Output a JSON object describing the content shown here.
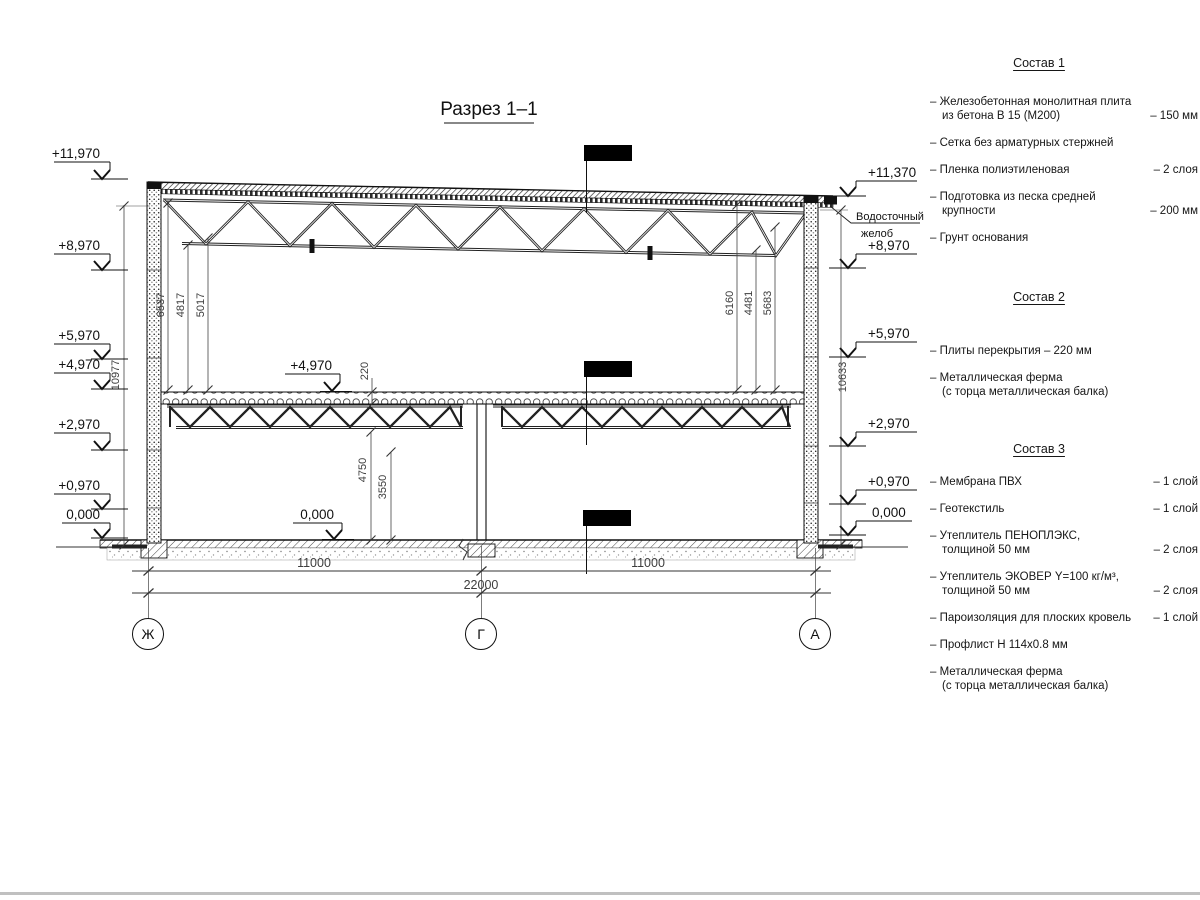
{
  "title": "Разрез 1–1",
  "drawing": {
    "elev_left": [
      "+11,970",
      "+8,970",
      "+5,970",
      "+4,970",
      "+2,970",
      "+0,970",
      "0,000"
    ],
    "elev_right": [
      "+11,370",
      "+8,970",
      "+5,970",
      "+2,970",
      "+0,970",
      "0,000"
    ],
    "elev_mid_floor": "+4,970",
    "elev_mid_zero": "0,000",
    "dim_left_total": "10977",
    "dim_right_total": "10633",
    "dim_left_inner": [
      "6537",
      "4817",
      "5017"
    ],
    "dim_right_inner": [
      "6160",
      "4481",
      "5683"
    ],
    "dim_slab": "220",
    "dim_v1": "4750",
    "dim_v2": "3550",
    "dim_span_left": "11000",
    "dim_span_right": "11000",
    "dim_total": "22000",
    "axes": [
      "Ж",
      "Г",
      "А"
    ],
    "gutter_label_1": "Водосточный",
    "gutter_label_2": "желоб"
  },
  "legend": {
    "sections": [
      {
        "title": "Состав 1",
        "items": [
          {
            "text": "– Железобетонная  монолитная плита\nиз бетона В 15 (М200)",
            "value": "–  150 мм"
          },
          {
            "text": "– Сетка без арматурных стержней",
            "value": ""
          },
          {
            "text": "– Пленка полиэтиленовая",
            "value": "–  2 слоя"
          },
          {
            "text": "– Подготовка из песка средней\nкрупности",
            "value": "–  200 мм"
          },
          {
            "text": "– Грунт основания",
            "value": ""
          }
        ]
      },
      {
        "title": "Состав 2",
        "items": [
          {
            "text": "– Плиты перекрытия – 220 мм",
            "value": ""
          },
          {
            "text": "– Металлическая ферма\n(с торца металлическая балка)",
            "value": ""
          }
        ]
      },
      {
        "title": "Состав 3",
        "items": [
          {
            "text": "– Мембрана ПВХ",
            "value": "– 1 слой"
          },
          {
            "text": "– Геотекстиль",
            "value": "– 1 слой"
          },
          {
            "text": "– Утеплитель ПЕНОПЛЭКС,\nтолщиной 50 мм",
            "value": "– 2 слоя"
          },
          {
            "text": "– Утеплитель ЭКОВЕР Y=100 кг/м³,\nтолщиной 50 мм",
            "value": "– 2 слоя"
          },
          {
            "text": "– Пароизоляция для плоских кровель",
            "value": "– 1 слой"
          },
          {
            "text": "– Профлист Н 114х0.8 мм",
            "value": ""
          },
          {
            "text": "– Металлическая ферма\n(с торца металлическая балка)",
            "value": ""
          }
        ]
      }
    ]
  }
}
